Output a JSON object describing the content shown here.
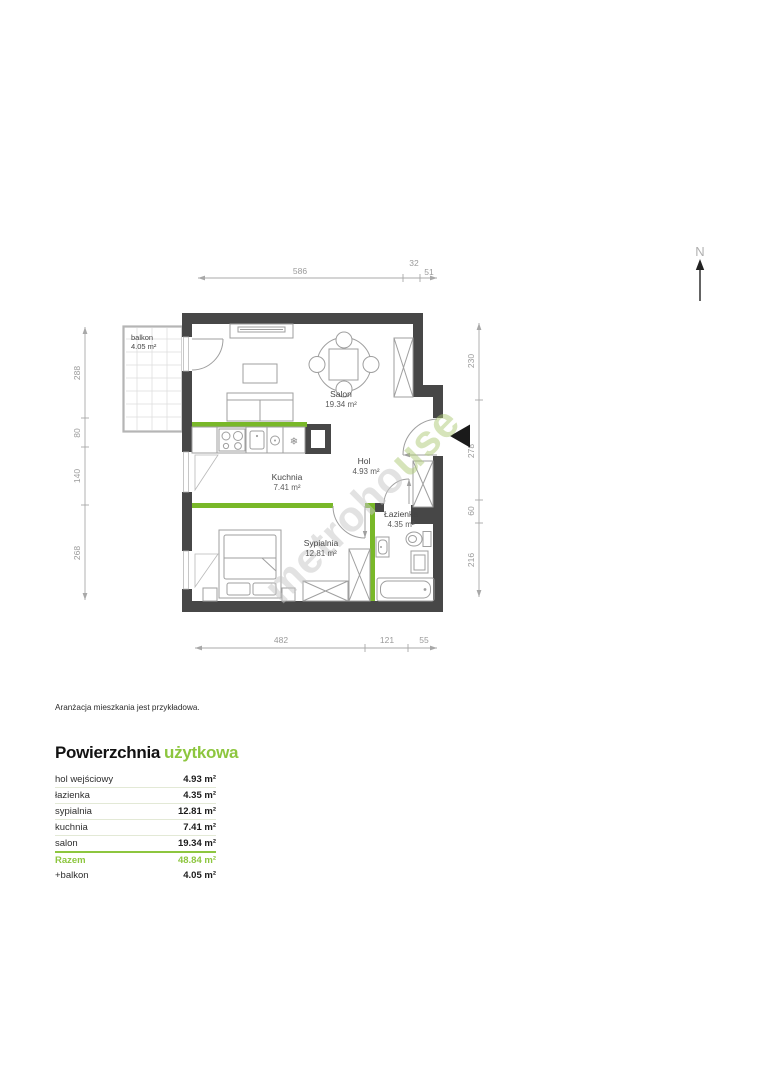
{
  "plan": {
    "north_label": "N",
    "note": "Aranżacja mieszkania jest przykładowa.",
    "watermark": {
      "part1": "metroho",
      "part2": "use"
    },
    "icons": {
      "freezer_glyph": "❄"
    },
    "rooms": {
      "salon": {
        "name": "Salon",
        "area": "19.34 m²"
      },
      "kuchnia": {
        "name": "Kuchnia",
        "area": "7.41 m²"
      },
      "hol": {
        "name": "Hol",
        "area": "4.93 m²"
      },
      "lazienka": {
        "name": "Łazienka",
        "area": "4.35 m²"
      },
      "sypialnia": {
        "name": "Sypialnia",
        "area": "12.81 m²"
      },
      "balkon": {
        "name": "balkon",
        "area": "4.05 m²"
      }
    },
    "dimensions": {
      "top": [
        "586",
        "32",
        "51"
      ],
      "bottom": [
        "482",
        "121",
        "55"
      ],
      "left": [
        "288",
        "80",
        "140",
        "268"
      ],
      "right": [
        "230",
        "278",
        "60",
        "216"
      ]
    }
  },
  "summary": {
    "title_black": "Powierzchnia",
    "title_green": "użytkowa",
    "rows": [
      {
        "label": "hol wejściowy",
        "value": "4.93 m²"
      },
      {
        "label": "łazienka",
        "value": "4.35 m²"
      },
      {
        "label": "sypialnia",
        "value": "12.81 m²"
      },
      {
        "label": "kuchnia",
        "value": "7.41 m²"
      },
      {
        "label": "salon",
        "value": "19.34 m²"
      }
    ],
    "total": {
      "label": "Razem",
      "value": "48.84 m²"
    },
    "extra": {
      "label": "+balkon",
      "value": "4.05 m²"
    }
  },
  "colors": {
    "accent_green": "#8dc63f",
    "partition_green": "#79b829",
    "wall": "#474747"
  }
}
